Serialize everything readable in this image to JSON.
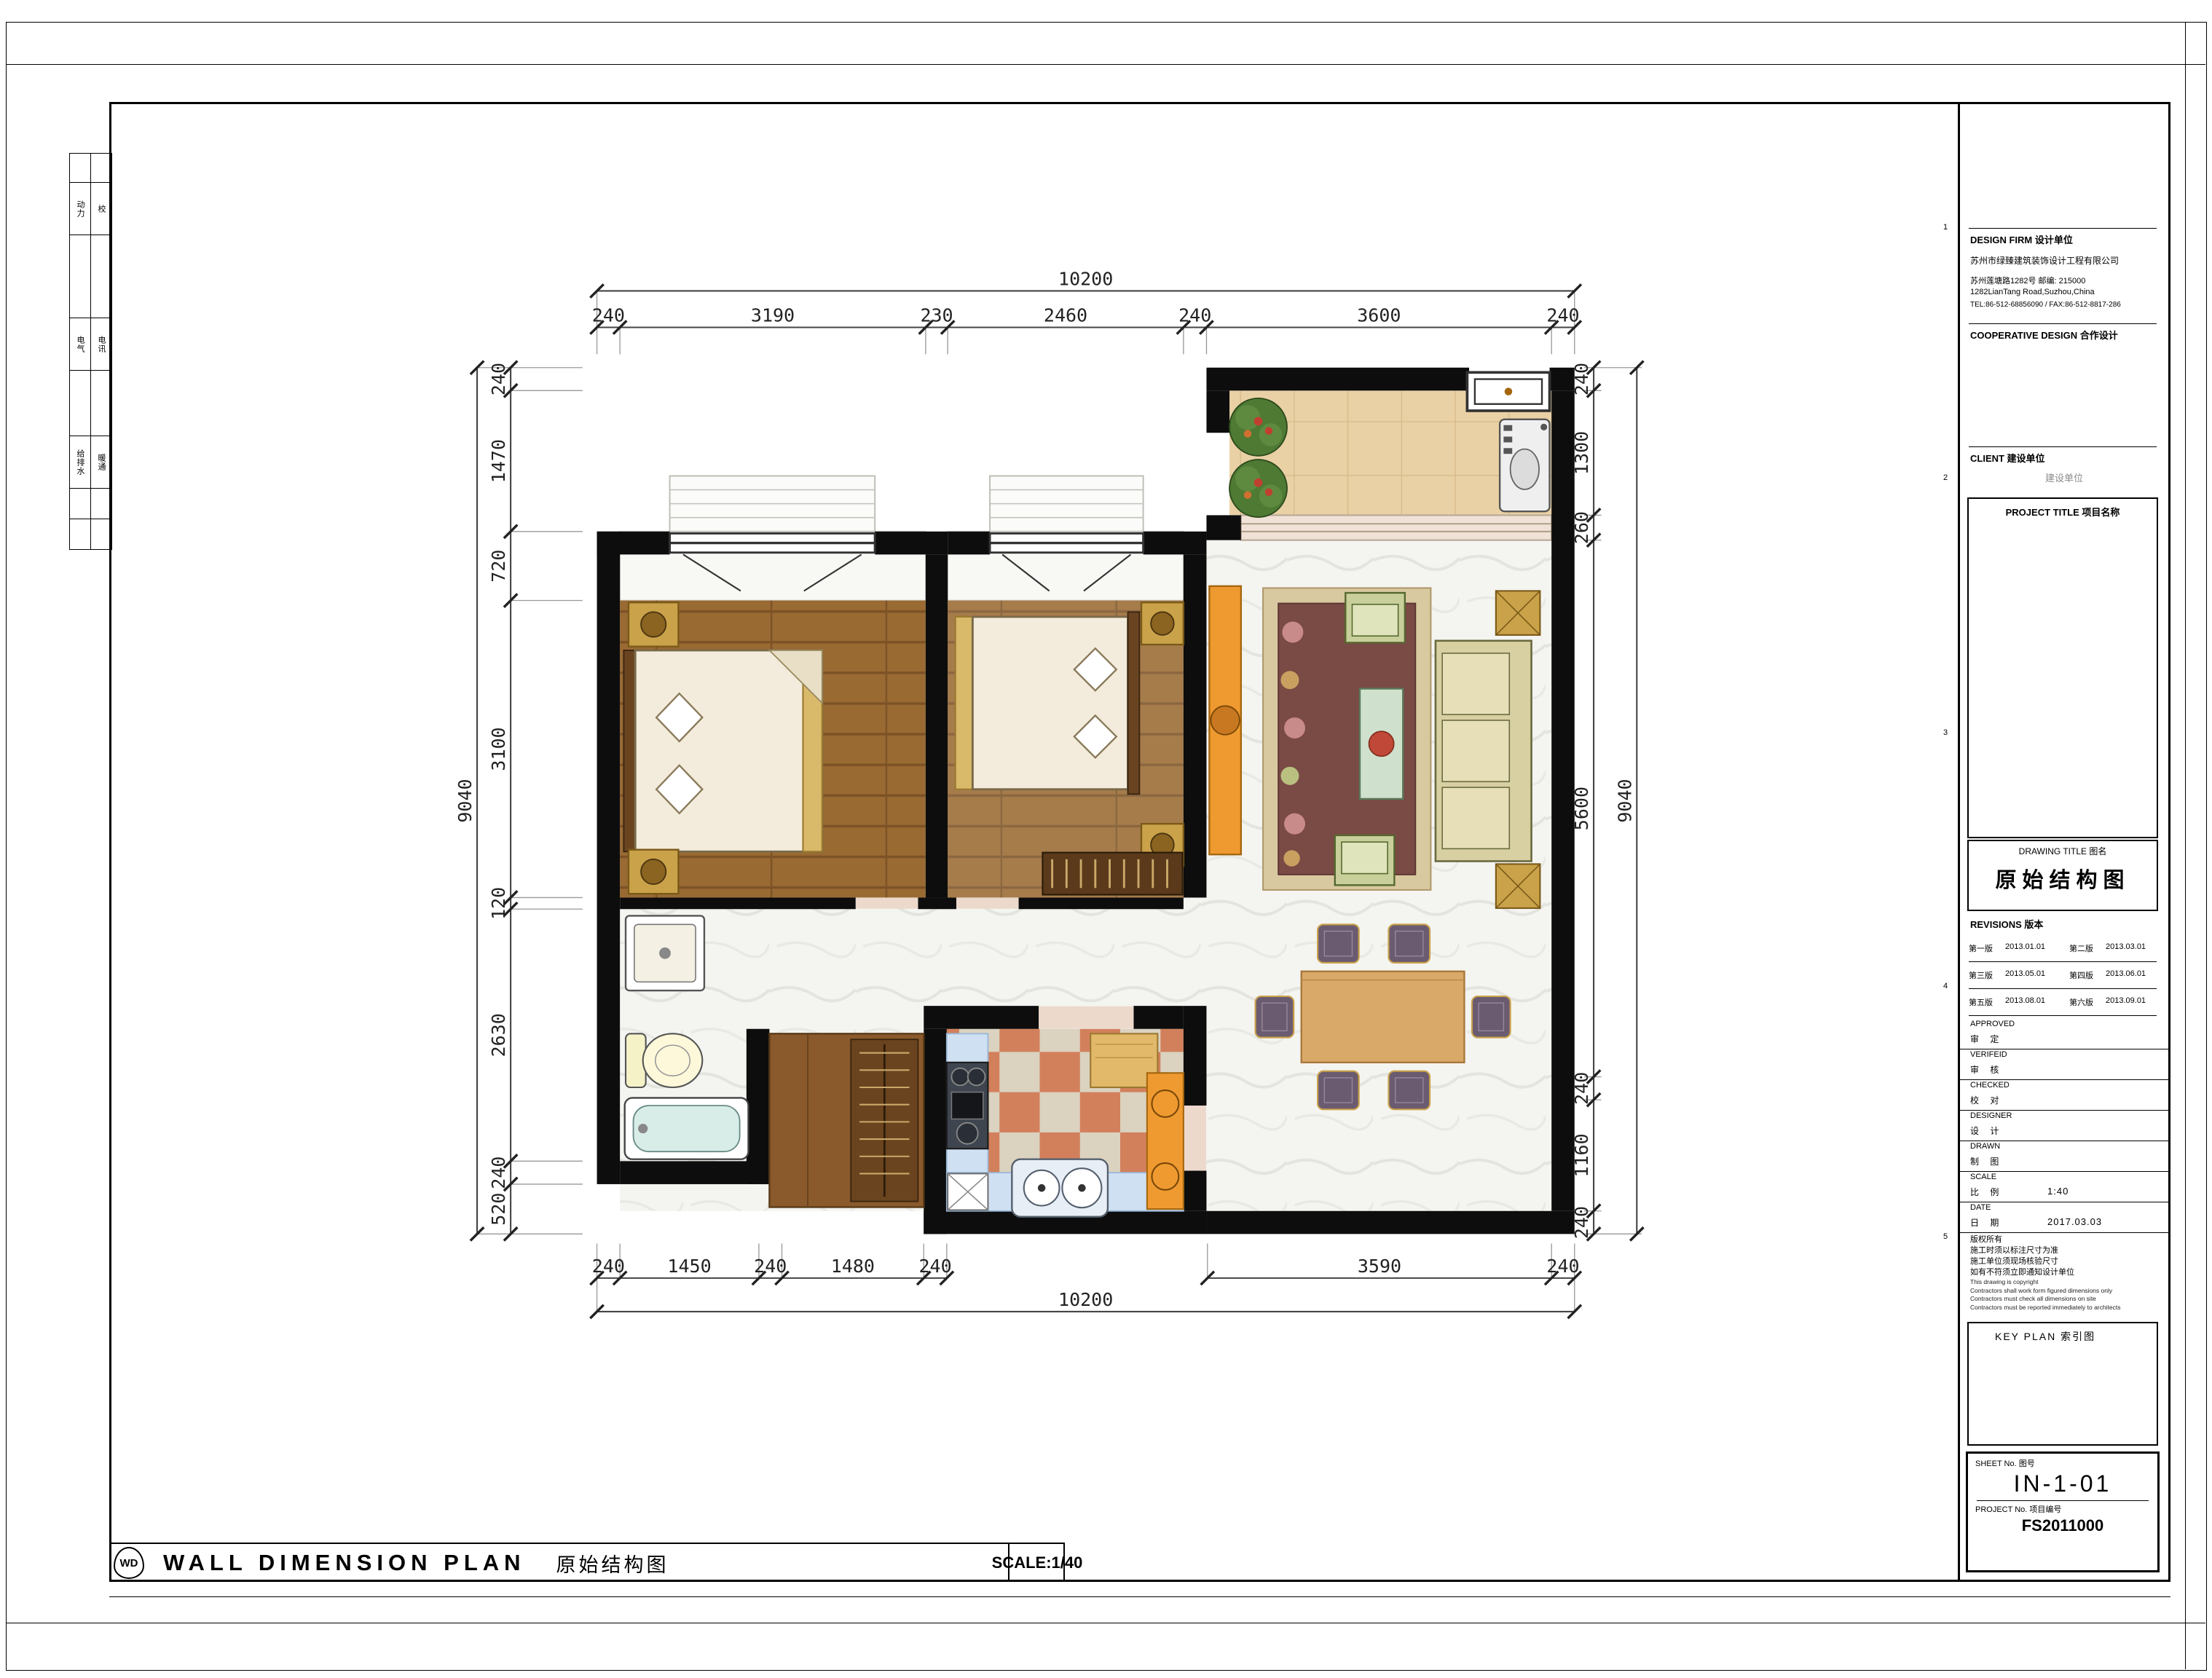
{
  "sheet": {
    "grid_refs": [
      "1",
      "2",
      "3",
      "4",
      "5"
    ],
    "left_strip": {
      "rows": [
        [
          "动力",
          "校"
        ],
        [
          "电气",
          "电讯"
        ],
        [
          "给排水",
          "暖通"
        ]
      ]
    }
  },
  "title_block": {
    "design_firm_label": "DESIGN FIRM    设计单位",
    "firm_name": "苏州市绿臻建筑装饰设计工程有限公司",
    "firm_addr_cn": "苏州莲塘路1282号   邮编: 215000",
    "firm_addr_en": "1282LianTang Road,Suzhou,China",
    "firm_tel": "TEL:86-512-68856090 / FAX:86-512-8817-286",
    "cooperative_label": "COOPERATIVE DESIGN    合作设计",
    "client_label": "CLIENT   建设单位",
    "client_value": "建设单位",
    "project_title_label": "PROJECT TITLE    项目名称",
    "drawing_title_label": "DRAWING TITLE    图名",
    "drawing_title": "原始结构图",
    "revisions_label": "REVISIONS   版本",
    "revisions": [
      {
        "name": "第一版",
        "date": "2013.01.01"
      },
      {
        "name": "第二版",
        "date": "2013.03.01"
      },
      {
        "name": "第三版",
        "date": "2013.05.01"
      },
      {
        "name": "第四版",
        "date": "2013.06.01"
      },
      {
        "name": "第五版",
        "date": "2013.08.01"
      },
      {
        "name": "第六版",
        "date": "2013.09.01"
      }
    ],
    "approved_en": "APPROVED",
    "approved_cn": "审  定",
    "verified_en": "VERIFEID",
    "verified_cn": "审  核",
    "checked_en": "CHECKED",
    "checked_cn": "校  对",
    "designer_en": "DESIGNER",
    "designer_cn": "设  计",
    "drawn_en": "DRAWN",
    "drawn_cn": "制  图",
    "scale_en": "SCALE",
    "scale_cn": "比  例",
    "scale_value": "1:40",
    "date_en": "DATE",
    "date_cn": "日  期",
    "date_value": "2017.03.03",
    "notes": [
      "版权所有",
      "施工时须以标注尺寸为准",
      "施工单位须现场核验尺寸",
      "如有不符须立即通知设计单位",
      "This drawing is copyright",
      "Contractors shall work form figured dimensions only",
      "Contractors must check all dimensions on site",
      "Contractors must be reported immediately to architects"
    ],
    "key_plan_label": "KEY PLAN   索引图",
    "sheet_no_label": "SHEET No.   图号",
    "sheet_no": "IN-1-01",
    "project_no_label": "PROJECT No.   项目编号",
    "project_no": "FS2011000"
  },
  "footer": {
    "logo": "WD",
    "title_en": "WALL DIMENSION PLAN",
    "title_cn": "原始结构图",
    "scale": "SCALE:1/40"
  },
  "plan": {
    "dims_top": {
      "overall": "10200",
      "chain": [
        "240",
        "3190",
        "230",
        "2460",
        "240",
        "3600",
        "240"
      ]
    },
    "dims_bottom": {
      "overall": "10200",
      "chain": [
        "240",
        "1450",
        "240",
        "1480",
        "240",
        "3590",
        "240"
      ]
    },
    "dims_left": {
      "overall": "9040",
      "chain": [
        "240",
        "1470",
        "720",
        "3100",
        "120",
        "2630",
        "240",
        "520"
      ]
    },
    "dims_right": {
      "overall": "9040",
      "chain": [
        "240",
        "1300",
        "260",
        "5600",
        "240",
        "1160",
        "240"
      ]
    }
  }
}
